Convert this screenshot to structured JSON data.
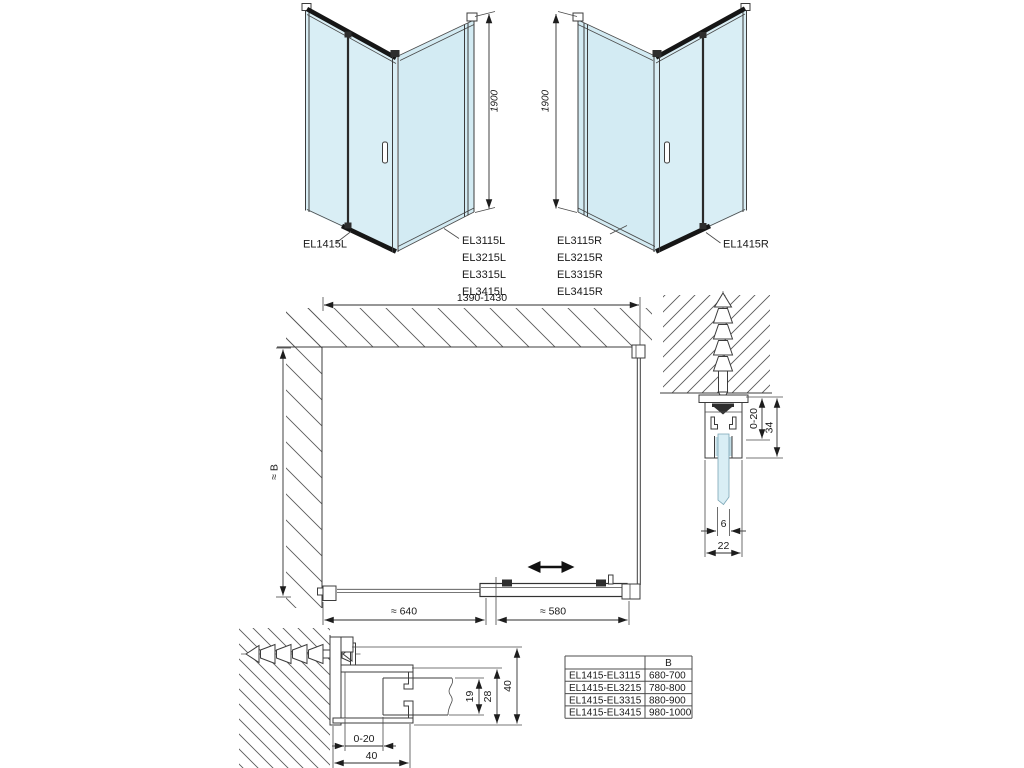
{
  "drawing": {
    "colors": {
      "glass": "#d9eef5",
      "line": "#3c3c3c",
      "hatch": "#5a5a5a"
    },
    "left_unit": {
      "door_label": "EL1415L",
      "panel_labels": [
        "EL3115L",
        "EL3215L",
        "EL3315L",
        "EL3415L"
      ],
      "height_dim": "1900"
    },
    "right_unit": {
      "door_label": "EL1415R",
      "panel_labels": [
        "EL3115R",
        "EL3215R",
        "EL3315R",
        "EL3415R"
      ],
      "height_dim": "1900"
    },
    "plan": {
      "width_dim": "1390-1430",
      "depth_dim": "≈ B",
      "fixed_segment_dim": "≈ 640",
      "door_segment_dim": "≈ 580"
    },
    "top_profile_detail": {
      "adjust_dim": "0-20",
      "profile_height_dim": "34",
      "glass_thickness_dim": "6",
      "profile_width_dim": "22"
    },
    "wall_profile_detail": {
      "glass_package_dim": "19",
      "inner_dim": "28",
      "profile_depth_dim": "40",
      "adjust_dim": "0-20",
      "profile_width_dim": "40"
    }
  },
  "size_table": {
    "b_header": "B",
    "rows": [
      {
        "combo": "EL1415-EL3115",
        "b": "680-700"
      },
      {
        "combo": "EL1415-EL3215",
        "b": "780-800"
      },
      {
        "combo": "EL1415-EL3315",
        "b": "880-900"
      },
      {
        "combo": "EL1415-EL3415",
        "b": "980-1000"
      }
    ]
  }
}
